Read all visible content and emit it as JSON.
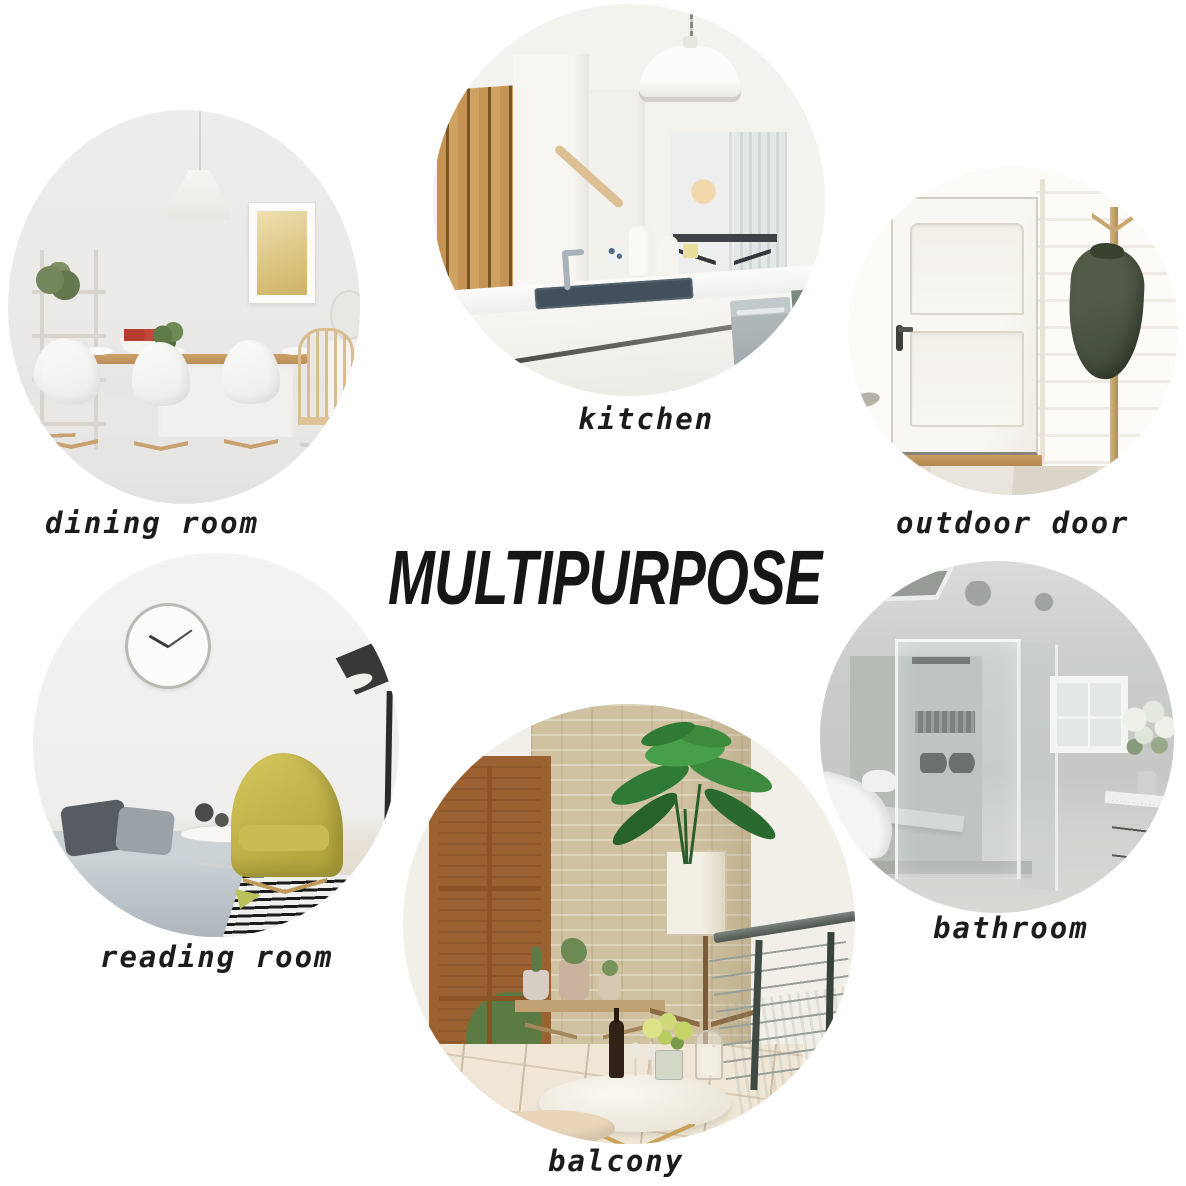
{
  "title": {
    "text": "MULTIPURPOSE"
  },
  "rooms": [
    {
      "id": "kitchen",
      "label": "kitchen"
    },
    {
      "id": "dining-room",
      "label": "dining room"
    },
    {
      "id": "outdoor-door",
      "label": "outdoor door"
    },
    {
      "id": "reading-room",
      "label": "reading room"
    },
    {
      "id": "bathroom",
      "label": "bathroom"
    },
    {
      "id": "balcony",
      "label": "balcony"
    }
  ],
  "colors": {
    "page_background": "#ffffff",
    "title_text": "#161616",
    "label_text": "#1c1c1c",
    "wood_accent": "#c79e66",
    "chair_yellow": "#cdbf55",
    "jacket_green": "#49523f",
    "plant_green": "#2f7a35",
    "brick_red": "#b2614a",
    "stone_wall": "#d0c2a1"
  }
}
